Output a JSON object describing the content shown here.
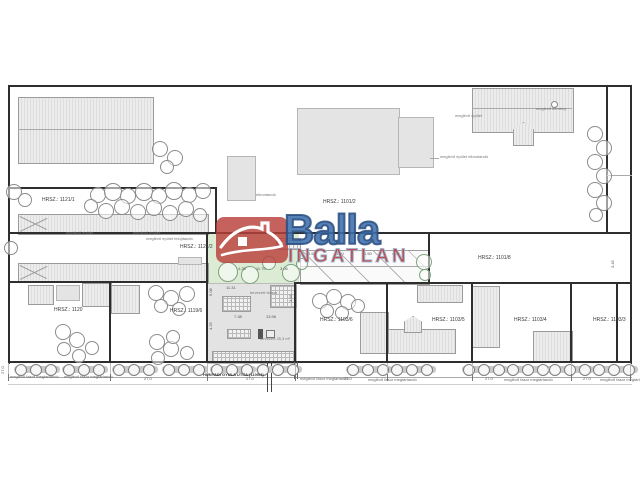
{
  "watermark": {
    "brand": "Balla",
    "subtitle": "INGATLAN",
    "logo": "red-house-icon",
    "colors": {
      "logo": "#ba403a",
      "brand": "#3e70ad",
      "brand_outline": "#2a4d80",
      "subtitle": "#b43a34",
      "subtitle_outline": "#9cb8d8"
    }
  },
  "drawing": {
    "kind": "helyszínrajz (site plan)",
    "street_name": "HUNYADI GYULA UTCA (1100/4)"
  },
  "annotations": [
    {
      "kind": "parcel-label",
      "text": "HRSZ.: 1101/2",
      "x": 323,
      "y": 200,
      "fs": 5,
      "color": "#3a3a3a"
    },
    {
      "kind": "parcel-label",
      "text": "HRSZ.: 1121/1",
      "x": 42,
      "y": 198,
      "fs": 5,
      "color": "#3a3a3a"
    },
    {
      "kind": "parcel-label",
      "text": "HRSZ.: 1121/2",
      "x": 180,
      "y": 245,
      "fs": 5,
      "color": "#3a3a3a"
    },
    {
      "kind": "parcel-label",
      "text": "HRSZ.: 1101/8",
      "x": 478,
      "y": 256,
      "fs": 5,
      "color": "#3a3a3a"
    },
    {
      "kind": "parcel-label",
      "text": "HRSZ.: 1120",
      "x": 54,
      "y": 308,
      "fs": 5,
      "color": "#3a3a3a"
    },
    {
      "kind": "parcel-label",
      "text": "HRSZ.: 1119/6",
      "x": 170,
      "y": 309,
      "fs": 5,
      "color": "#3a3a3a"
    },
    {
      "kind": "parcel-label",
      "text": "HRSZ.: 1103/6",
      "x": 320,
      "y": 318,
      "fs": 5,
      "color": "#3a3a3a"
    },
    {
      "kind": "parcel-label",
      "text": "HRSZ.: 1103/5",
      "x": 432,
      "y": 318,
      "fs": 5,
      "color": "#3a3a3a"
    },
    {
      "kind": "parcel-label",
      "text": "HRSZ.: 1103/4",
      "x": 514,
      "y": 318,
      "fs": 5,
      "color": "#3a3a3a"
    },
    {
      "kind": "parcel-label",
      "text": "HRSZ.: 1103/3",
      "x": 593,
      "y": 318,
      "fs": 5,
      "color": "#3a3a3a"
    },
    {
      "kind": "note",
      "text": "meglévő épület",
      "x": 455,
      "y": 114,
      "fs": 4,
      "color": "#777"
    },
    {
      "kind": "note",
      "text": "meglévő kémény",
      "x": 536,
      "y": 107,
      "fs": 4,
      "color": "#777"
    },
    {
      "kind": "note",
      "text": "meglévő épület elbontandó",
      "x": 440,
      "y": 155,
      "fs": 4,
      "color": "#777"
    },
    {
      "kind": "note",
      "text": "elbontandó",
      "x": 256,
      "y": 193,
      "fs": 4,
      "color": "#777"
    },
    {
      "kind": "note",
      "text": "meglévő épület",
      "x": 66,
      "y": 231,
      "fs": 4,
      "color": "#777"
    },
    {
      "kind": "note",
      "text": "meglévő épület",
      "x": 133,
      "y": 231,
      "fs": 4,
      "color": "#777"
    },
    {
      "kind": "note",
      "text": "meglévő épület felújítandó",
      "x": 146,
      "y": 237,
      "fs": 4,
      "color": "#777"
    },
    {
      "kind": "note",
      "text": "tervezett terasz",
      "x": 250,
      "y": 291,
      "fs": 4,
      "color": "#777"
    },
    {
      "kind": "note",
      "text": "tervezett 25,3 m²",
      "x": 260,
      "y": 337,
      "fs": 4,
      "color": "#777"
    },
    {
      "kind": "dimension",
      "text": "11.31",
      "x": 226,
      "y": 286,
      "fs": 4,
      "color": "#555"
    },
    {
      "kind": "dimension",
      "text": "4.25",
      "x": 238,
      "y": 267,
      "fs": 4,
      "color": "#555"
    },
    {
      "kind": "dimension",
      "text": "11.70",
      "x": 256,
      "y": 267,
      "fs": 4,
      "color": "#555"
    },
    {
      "kind": "dimension",
      "text": "3.06",
      "x": 280,
      "y": 267,
      "fs": 4,
      "color": "#555"
    },
    {
      "kind": "dimension",
      "text": "4.50",
      "x": 308,
      "y": 252,
      "fs": 4,
      "color": "#555"
    },
    {
      "kind": "dimension",
      "text": "4.50",
      "x": 336,
      "y": 252,
      "fs": 4,
      "color": "#555"
    },
    {
      "kind": "dimension",
      "text": "4.50",
      "x": 364,
      "y": 252,
      "fs": 4,
      "color": "#555"
    },
    {
      "kind": "dimension",
      "text": "4.50",
      "x": 392,
      "y": 252,
      "fs": 4,
      "color": "#555"
    },
    {
      "kind": "dimension",
      "text": "7.38",
      "x": 234,
      "y": 315,
      "fs": 4,
      "color": "#555"
    },
    {
      "kind": "dimension",
      "text": "13.96",
      "x": 266,
      "y": 315,
      "fs": 4,
      "color": "#555"
    },
    {
      "kind": "dimension",
      "text": "5.08",
      "x": 209,
      "y": 296,
      "fs": 4,
      "color": "#555",
      "rot": -90
    },
    {
      "kind": "dimension",
      "text": "4.25",
      "x": 209,
      "y": 330,
      "fs": 4,
      "color": "#555",
      "rot": -90
    },
    {
      "kind": "dimension",
      "text": "3.45",
      "x": 289,
      "y": 302,
      "fs": 4,
      "color": "#555",
      "rot": -90
    },
    {
      "kind": "dimension",
      "text": "3.45",
      "x": 611,
      "y": 268,
      "fs": 4,
      "color": "#555",
      "rot": -90
    },
    {
      "kind": "dimension",
      "text": "27.0",
      "x": 1,
      "y": 374,
      "fs": 4,
      "color": "#555",
      "rot": -90
    },
    {
      "kind": "street-note",
      "text": "meglévő fasor megtartandó",
      "x": 10,
      "y": 375,
      "fs": 4,
      "color": "#666"
    },
    {
      "kind": "street-note",
      "text": "meglévő fasor megtartandó",
      "x": 64,
      "y": 375,
      "fs": 4,
      "color": "#666"
    },
    {
      "kind": "dimension",
      "text": "27.0",
      "x": 144,
      "y": 377,
      "fs": 4,
      "color": "#555"
    },
    {
      "kind": "street-name",
      "text": "HUNYADI GYULA UTCA (1100/4)",
      "x": 203,
      "y": 373,
      "fs": 4,
      "color": "#333",
      "bold": true
    },
    {
      "kind": "dimension",
      "text": "27.0",
      "x": 246,
      "y": 377,
      "fs": 4,
      "color": "#555"
    },
    {
      "kind": "street-note",
      "text": "meglévő fasor megtartandó",
      "x": 300,
      "y": 377,
      "fs": 4,
      "color": "#666"
    },
    {
      "kind": "dimension",
      "text": "27.0",
      "x": 344,
      "y": 377,
      "fs": 4,
      "color": "#555"
    },
    {
      "kind": "street-note",
      "text": "meglévő fasor megtartandó",
      "x": 368,
      "y": 378,
      "fs": 4,
      "color": "#666"
    },
    {
      "kind": "dimension",
      "text": "27.0",
      "x": 485,
      "y": 377,
      "fs": 4,
      "color": "#555"
    },
    {
      "kind": "street-note",
      "text": "meglévő fasor megtartandó",
      "x": 504,
      "y": 378,
      "fs": 4,
      "color": "#666"
    },
    {
      "kind": "dimension",
      "text": "27.0",
      "x": 583,
      "y": 377,
      "fs": 4,
      "color": "#555"
    },
    {
      "kind": "street-note",
      "text": "meglévő fasor megtartandó",
      "x": 600,
      "y": 378,
      "fs": 4,
      "color": "#666"
    }
  ]
}
